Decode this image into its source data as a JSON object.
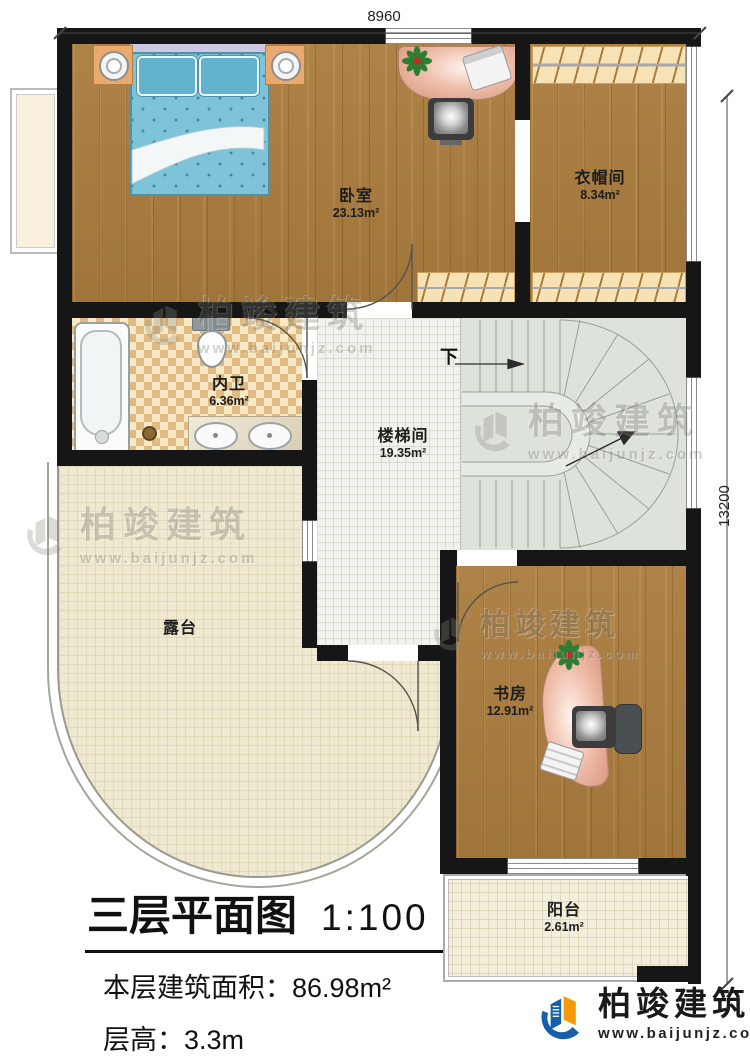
{
  "plan": {
    "dimension_top": "8960",
    "dimension_right": "13200",
    "stairs_direction_label": "下",
    "rooms": [
      {
        "name": "卧室",
        "area": "23.13m²"
      },
      {
        "name": "衣帽间",
        "area": "8.34m²"
      },
      {
        "name": "内卫",
        "area": "6.36m²"
      },
      {
        "name": "楼梯间",
        "area": "19.35m²"
      },
      {
        "name": "露台",
        "area": ""
      },
      {
        "name": "书房",
        "area": "12.91m²"
      },
      {
        "name": "阳台",
        "area": "2.61m²"
      }
    ]
  },
  "title_block": {
    "title": "三层平面图",
    "scale": "1:100",
    "floor_area_label": "本层建筑面积：",
    "floor_area_value": "86.98m²",
    "floor_height_label": "层高：",
    "floor_height_value": "3.3m"
  },
  "branding": {
    "company": "柏竣建筑",
    "website": "www.baijunjz.com"
  },
  "watermark": {
    "company": "柏竣建筑",
    "website": "www.baijunjz.com"
  },
  "colors": {
    "wall": "#161616",
    "wood": "#aa7c3e",
    "tile": "#e0ba80",
    "stair_floor": "#dde3db",
    "terrace_floor": "#efe9d1",
    "desk_accent": "#e8b09c",
    "bed_blue": "#7ec3d8",
    "logo_blue": "#1660a8",
    "logo_orange": "#f5990b"
  }
}
